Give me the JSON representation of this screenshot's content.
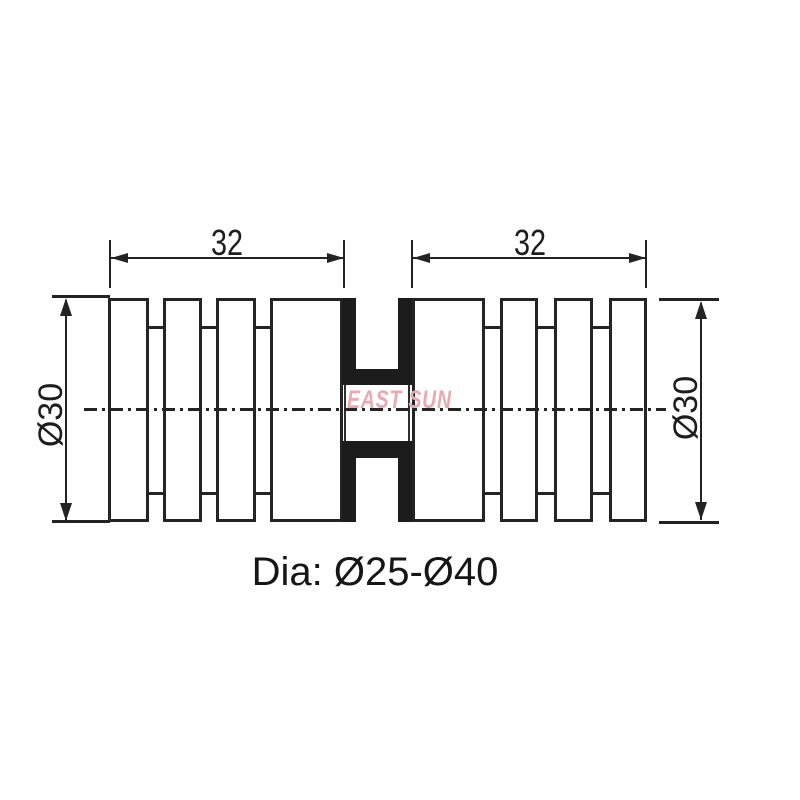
{
  "watermark": {
    "text": "EAST SUN",
    "color": "#e9a9ae"
  },
  "caption": {
    "text": "Dia: Ø25-Ø40"
  },
  "dimensions": {
    "left_width": {
      "label": "32"
    },
    "right_width": {
      "label": "32"
    },
    "left_diameter": {
      "label": "Ø30"
    },
    "right_diameter": {
      "label": "Ø30"
    }
  },
  "colors": {
    "background": "#ffffff",
    "line": "#232323",
    "fill": "#1c1c1c",
    "watermark": "#e9a9ae",
    "text": "#1d1d1d"
  }
}
